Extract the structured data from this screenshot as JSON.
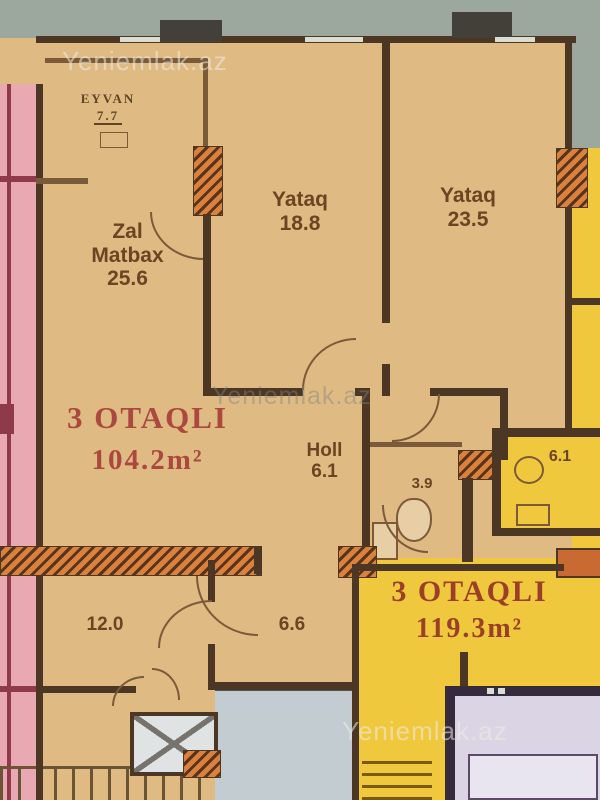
{
  "site_watermark": "Yeniemlak.az",
  "apartment_104": {
    "type": "3 OTAQLI",
    "area": "104.2m²",
    "rooms": {
      "eyvan": {
        "name": "EYVAN",
        "area": "7.7"
      },
      "zal_matbax": {
        "line1": "Zal",
        "line2": "Matbax",
        "area": "25.6"
      },
      "yataq_1": {
        "name": "Yataq",
        "area": "18.8"
      },
      "yataq_2": {
        "name": "Yataq",
        "area": "23.5"
      },
      "holl": {
        "name": "Holl",
        "area": "6.1"
      },
      "sanitary": {
        "area": "3.9"
      },
      "room_bottom": {
        "area": "12.0"
      },
      "corridor": {
        "area": "6.6"
      }
    }
  },
  "apartment_119": {
    "type": "3 OTAQLI",
    "area": "119.3m²",
    "rooms": {
      "bath": {
        "area": "6.1"
      }
    }
  },
  "colors": {
    "wall": "#4b3723",
    "floor_tan": "#dfbb83",
    "floor_yellow": "#f0c83e",
    "neighbor_pink": "#e8a9b2",
    "room_lavender": "#dbd4e4",
    "stair_gray": "#c3ccd1",
    "exterior_gray": "#9ca79d",
    "hatch_orange": "#d9813f",
    "apartment_label_red": "#ab4840",
    "room_label_brown": "#6d4423"
  }
}
